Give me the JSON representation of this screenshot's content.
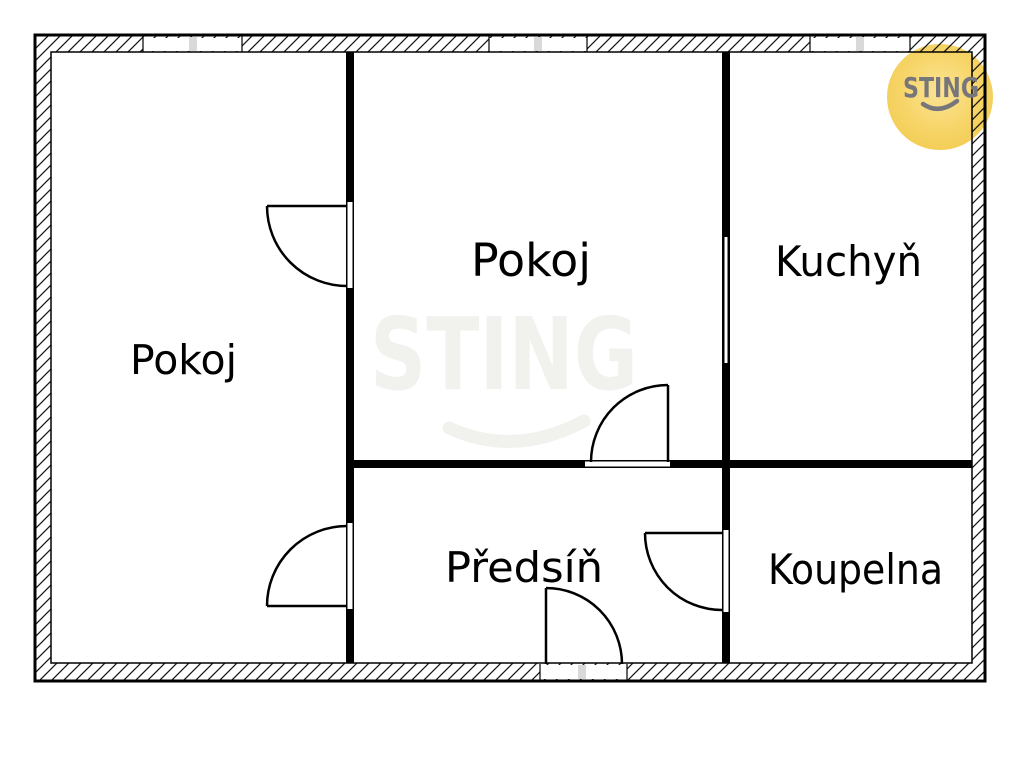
{
  "plan": {
    "rooms": [
      {
        "id": "pokoj-left",
        "label": "Pokoj"
      },
      {
        "id": "pokoj-middle",
        "label": "Pokoj"
      },
      {
        "id": "kuchyn",
        "label": "Kuchyň"
      },
      {
        "id": "predsin",
        "label": "Předsíň"
      },
      {
        "id": "koupelna",
        "label": "Koupelna"
      }
    ],
    "windows_visible": 3,
    "doors_visible": 5
  },
  "watermark": {
    "text": "STING"
  },
  "logo": {
    "text": "STING"
  },
  "colors": {
    "wall": "#000000",
    "window_tick": "#d9d9d9",
    "watermark": "#f1f1ee",
    "logo_yellow": "#f6cd51",
    "logo_text": "#76767b",
    "background": "#ffffff"
  }
}
